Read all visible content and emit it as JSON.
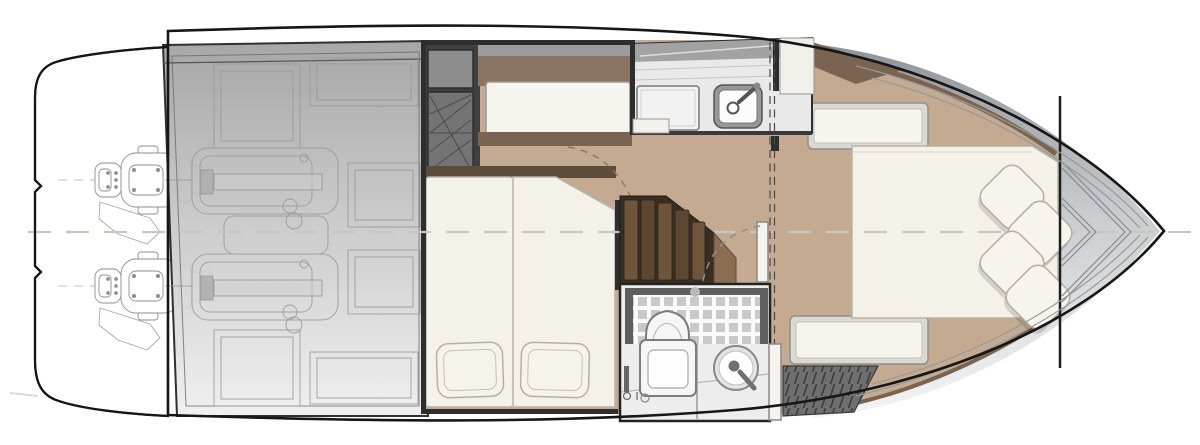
{
  "diagram": {
    "type": "yacht-floor-plan",
    "view": "top-down interior layout, bow pointing right",
    "rooms": [
      {
        "id": "swim-platform",
        "name": "swim platform"
      },
      {
        "id": "engine-room",
        "name": "engine room"
      },
      {
        "id": "guest-cabin",
        "name": "twin guest cabin"
      },
      {
        "id": "galley",
        "name": "galley"
      },
      {
        "id": "companionway",
        "name": "companionway stairs"
      },
      {
        "id": "head",
        "name": "head / shower room"
      },
      {
        "id": "master-cabin",
        "name": "forward master cabin"
      },
      {
        "id": "bow-locker",
        "name": "bow anchor locker"
      }
    ],
    "equipment": {
      "outboard_engines": 2,
      "twin_beds": 2,
      "twin_bed_pillows": 2,
      "master_bed_pillows": 4,
      "side_benches": 2,
      "galley_fixtures": [
        "cooktop",
        "sink with mixer tap"
      ],
      "head_fixtures": [
        "shower with tiled floor",
        "toilet",
        "round washbasin"
      ]
    },
    "annotations": {
      "centerline": "horizontal dashed hull centerline",
      "section_line": "vertical double-dashed bulkhead line at galley",
      "door_swings": 2
    },
    "colors": {
      "hull_line": "#161616",
      "wood": "#c3aa91",
      "wood_trim": "#7a6350",
      "mattress": "#f4f1e9",
      "stair_dark": "#3a2e23",
      "stair_step": "#6e543b",
      "wedge_brown": "#8a6d52",
      "tile": "#c9c9c9",
      "wall_dark": "#2e2e2e",
      "deck_gray_top": "#8f949a",
      "counter": "#e9e9e9",
      "hatch_gray": "#6f6f6f",
      "headboard_brown": "#8b7460",
      "centerline_gray": "#c9c6c0"
    }
  }
}
